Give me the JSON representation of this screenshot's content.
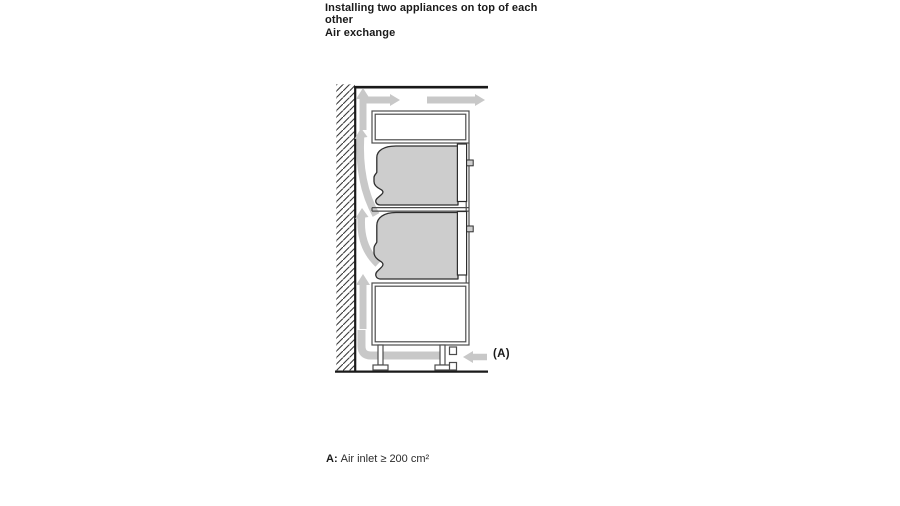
{
  "header": {
    "heading": [
      "Installing two appliances on top of each",
      "other",
      "Air exchange"
    ]
  },
  "diagram": {
    "label_a": "(A)",
    "icons": {
      "wall-hatch": "diagonal-hatched-wall",
      "airflow-arrow-up-top": "up-arrow",
      "airflow-arrow-right-inner": "right-arrow",
      "airflow-arrow-right-outer": "right-arrow",
      "airflow-curve-upper": "curved-up-arrow",
      "airflow-curve-lower": "curved-up-arrow",
      "airflow-arrow-up-mid": "up-arrow",
      "airflow-under-cabinet": "l-shaped-flow-band",
      "air-inlet-arrow": "left-arrow"
    }
  },
  "caption": {
    "prefix": "A:",
    "text": "Air inlet ≥ 200 cm²"
  },
  "colors": {
    "ink": "#1a1a1a",
    "outline": "#2e2e2e",
    "structure": "#4d4d4d",
    "appliance-fill": "#cdcdcd",
    "airflow": "#c8c8c8",
    "wall": "#1a1a1a",
    "background": "#ffffff",
    "caption-ink": "#2b2b2b"
  }
}
